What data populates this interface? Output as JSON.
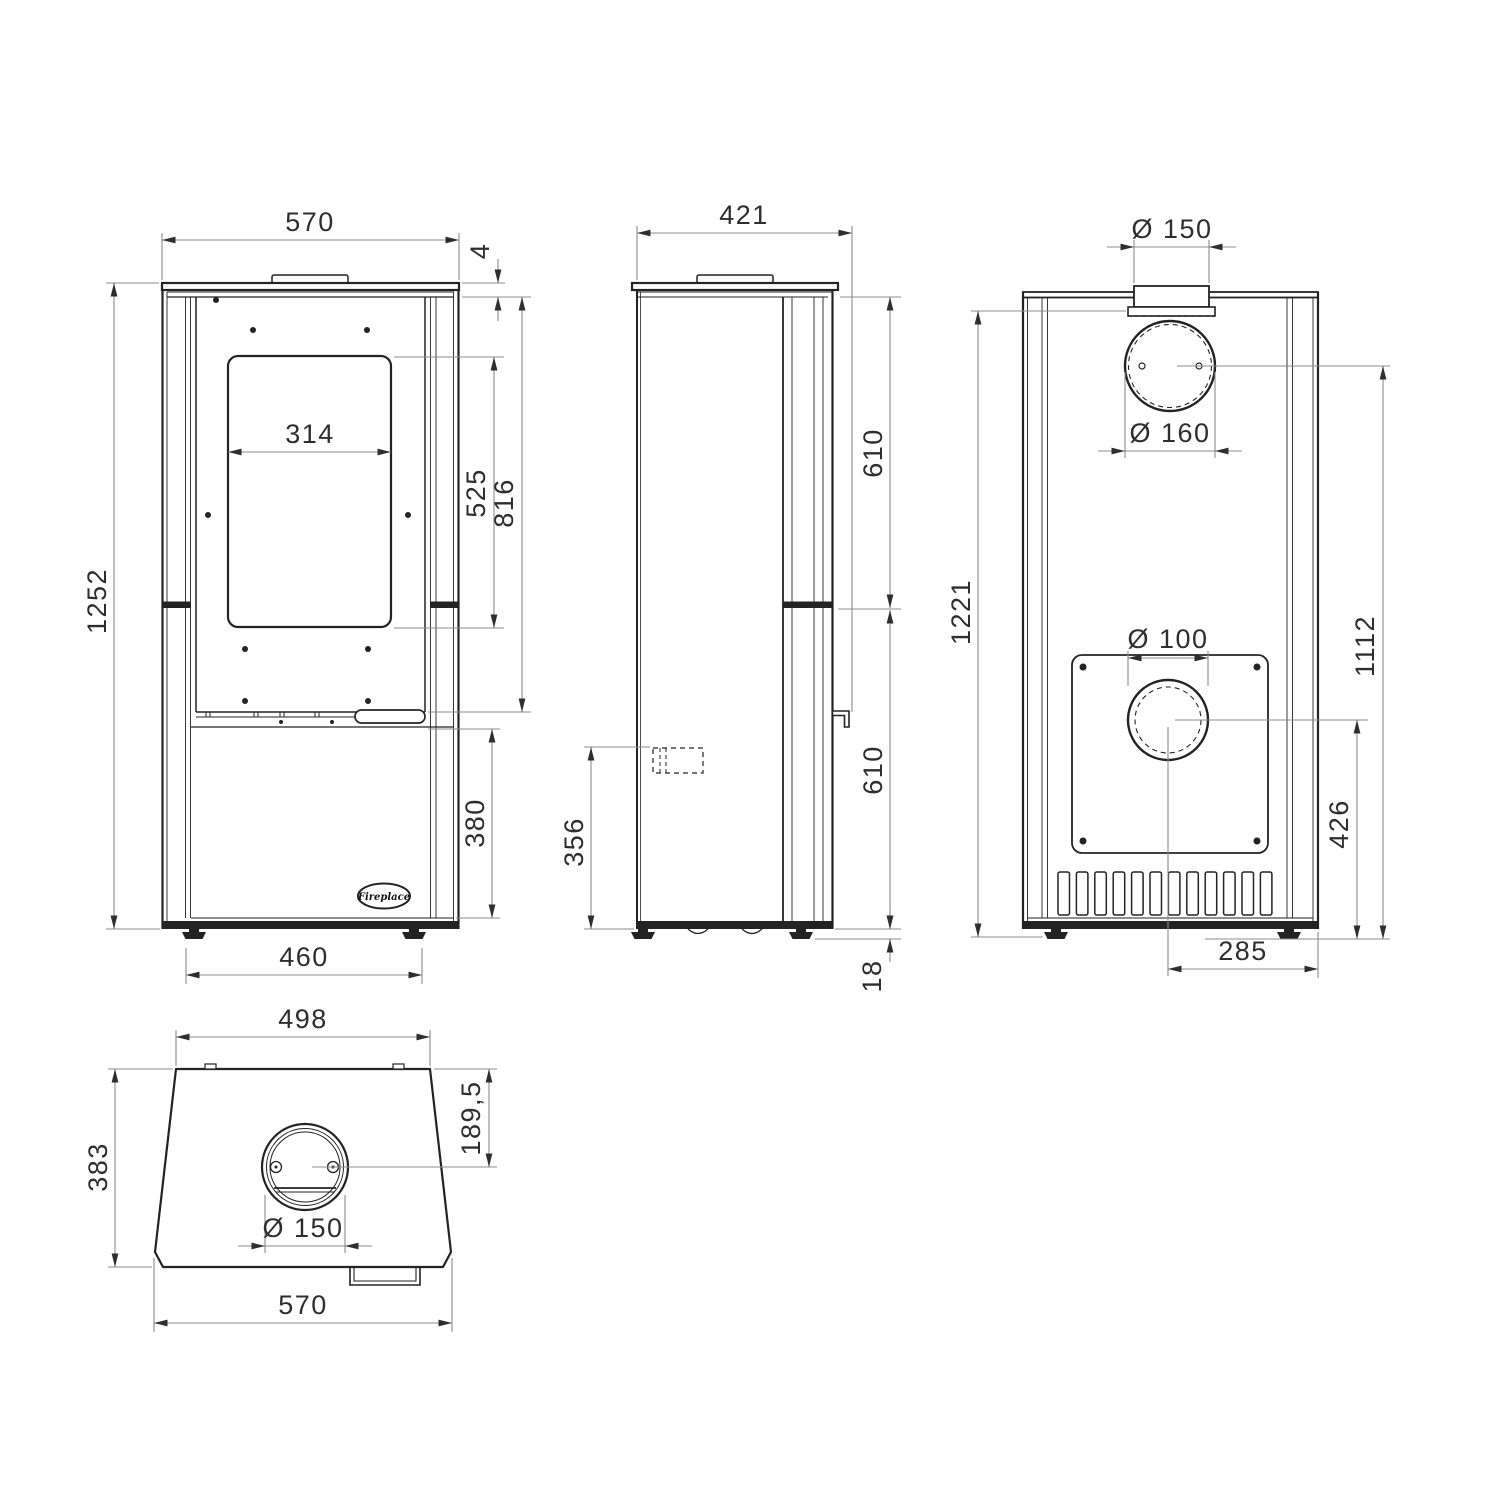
{
  "drawing": {
    "type": "stove technical dimension drawing",
    "background": "#ffffff",
    "line_color": "#232323",
    "dim_line_color": "#8c8c8c",
    "text_color": "#2e2e2e",
    "logo_text": "Fireplace"
  },
  "views": {
    "front": {
      "dims": {
        "overall_width": "570",
        "top_plate_thickness": "4",
        "overall_height": "1252",
        "glass_width": "314",
        "glass_height": "525",
        "door_bottom_height": "816",
        "drawer_height": "380",
        "feet_spacing": "460"
      }
    },
    "side": {
      "dims": {
        "depth": "421",
        "upper_body_height": "610",
        "lower_body_height": "610",
        "inlet_height": "356",
        "foot_height": "18"
      }
    },
    "rear": {
      "dims": {
        "flue_collar_diameter": "Ø 150",
        "flue_opening_diameter": "Ø 160",
        "body_height": "1221",
        "air_inlet_diameter": "Ø 100",
        "flue_center_height": "1112",
        "air_inlet_center_height": "426",
        "air_inlet_offset": "285"
      }
    },
    "top": {
      "dims": {
        "body_width": "498",
        "depth": "383",
        "flue_center_offset": "189,5",
        "flue_diameter": "Ø 150",
        "overall_width": "570"
      }
    }
  }
}
